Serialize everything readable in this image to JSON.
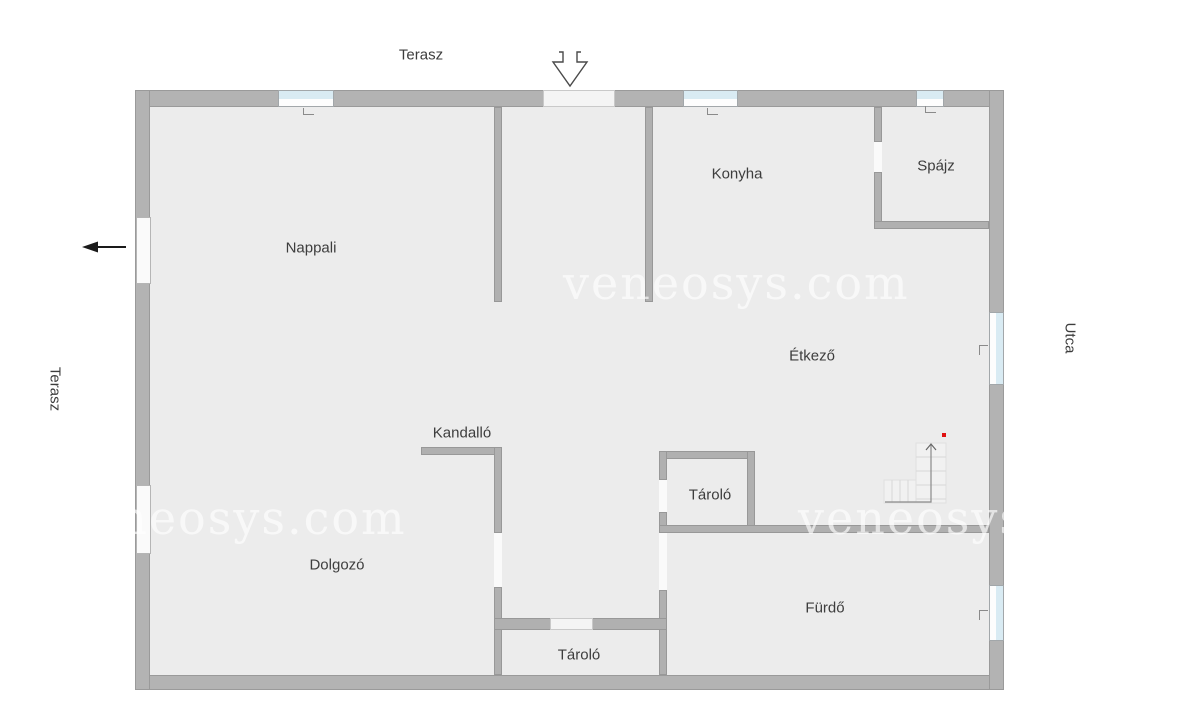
{
  "outside_labels": {
    "terrace_top": "Terasz",
    "terrace_left": "Terasz",
    "street": "Utca"
  },
  "rooms": {
    "living": "Nappali",
    "kitchen": "Konyha",
    "pantry": "Spájz",
    "dining": "Étkező",
    "fireplace": "Kandalló",
    "storage_middle": "Tároló",
    "study": "Dolgozó",
    "storage_bottom": "Tároló",
    "bathroom": "Fürdő"
  },
  "watermarks": {
    "center": "veneosys.com",
    "bottom_left": "veneosys.com",
    "bottom_right": "veneosys.com"
  },
  "icons": {
    "entrance": "entrance-arrow-down",
    "terrace_exit": "black-arrow-left",
    "stairs": "stairs-up-arrow",
    "stairs_marker": "red-dot"
  },
  "colors": {
    "wall": "#b3b3b3",
    "wall_edge": "#9a9a9a",
    "floor": "#ececec",
    "glass": "#d9ebf3",
    "opening": "#fafafa",
    "label": "#3d3d3d",
    "arrow": "#1a1a1a",
    "red": "#e01010"
  }
}
